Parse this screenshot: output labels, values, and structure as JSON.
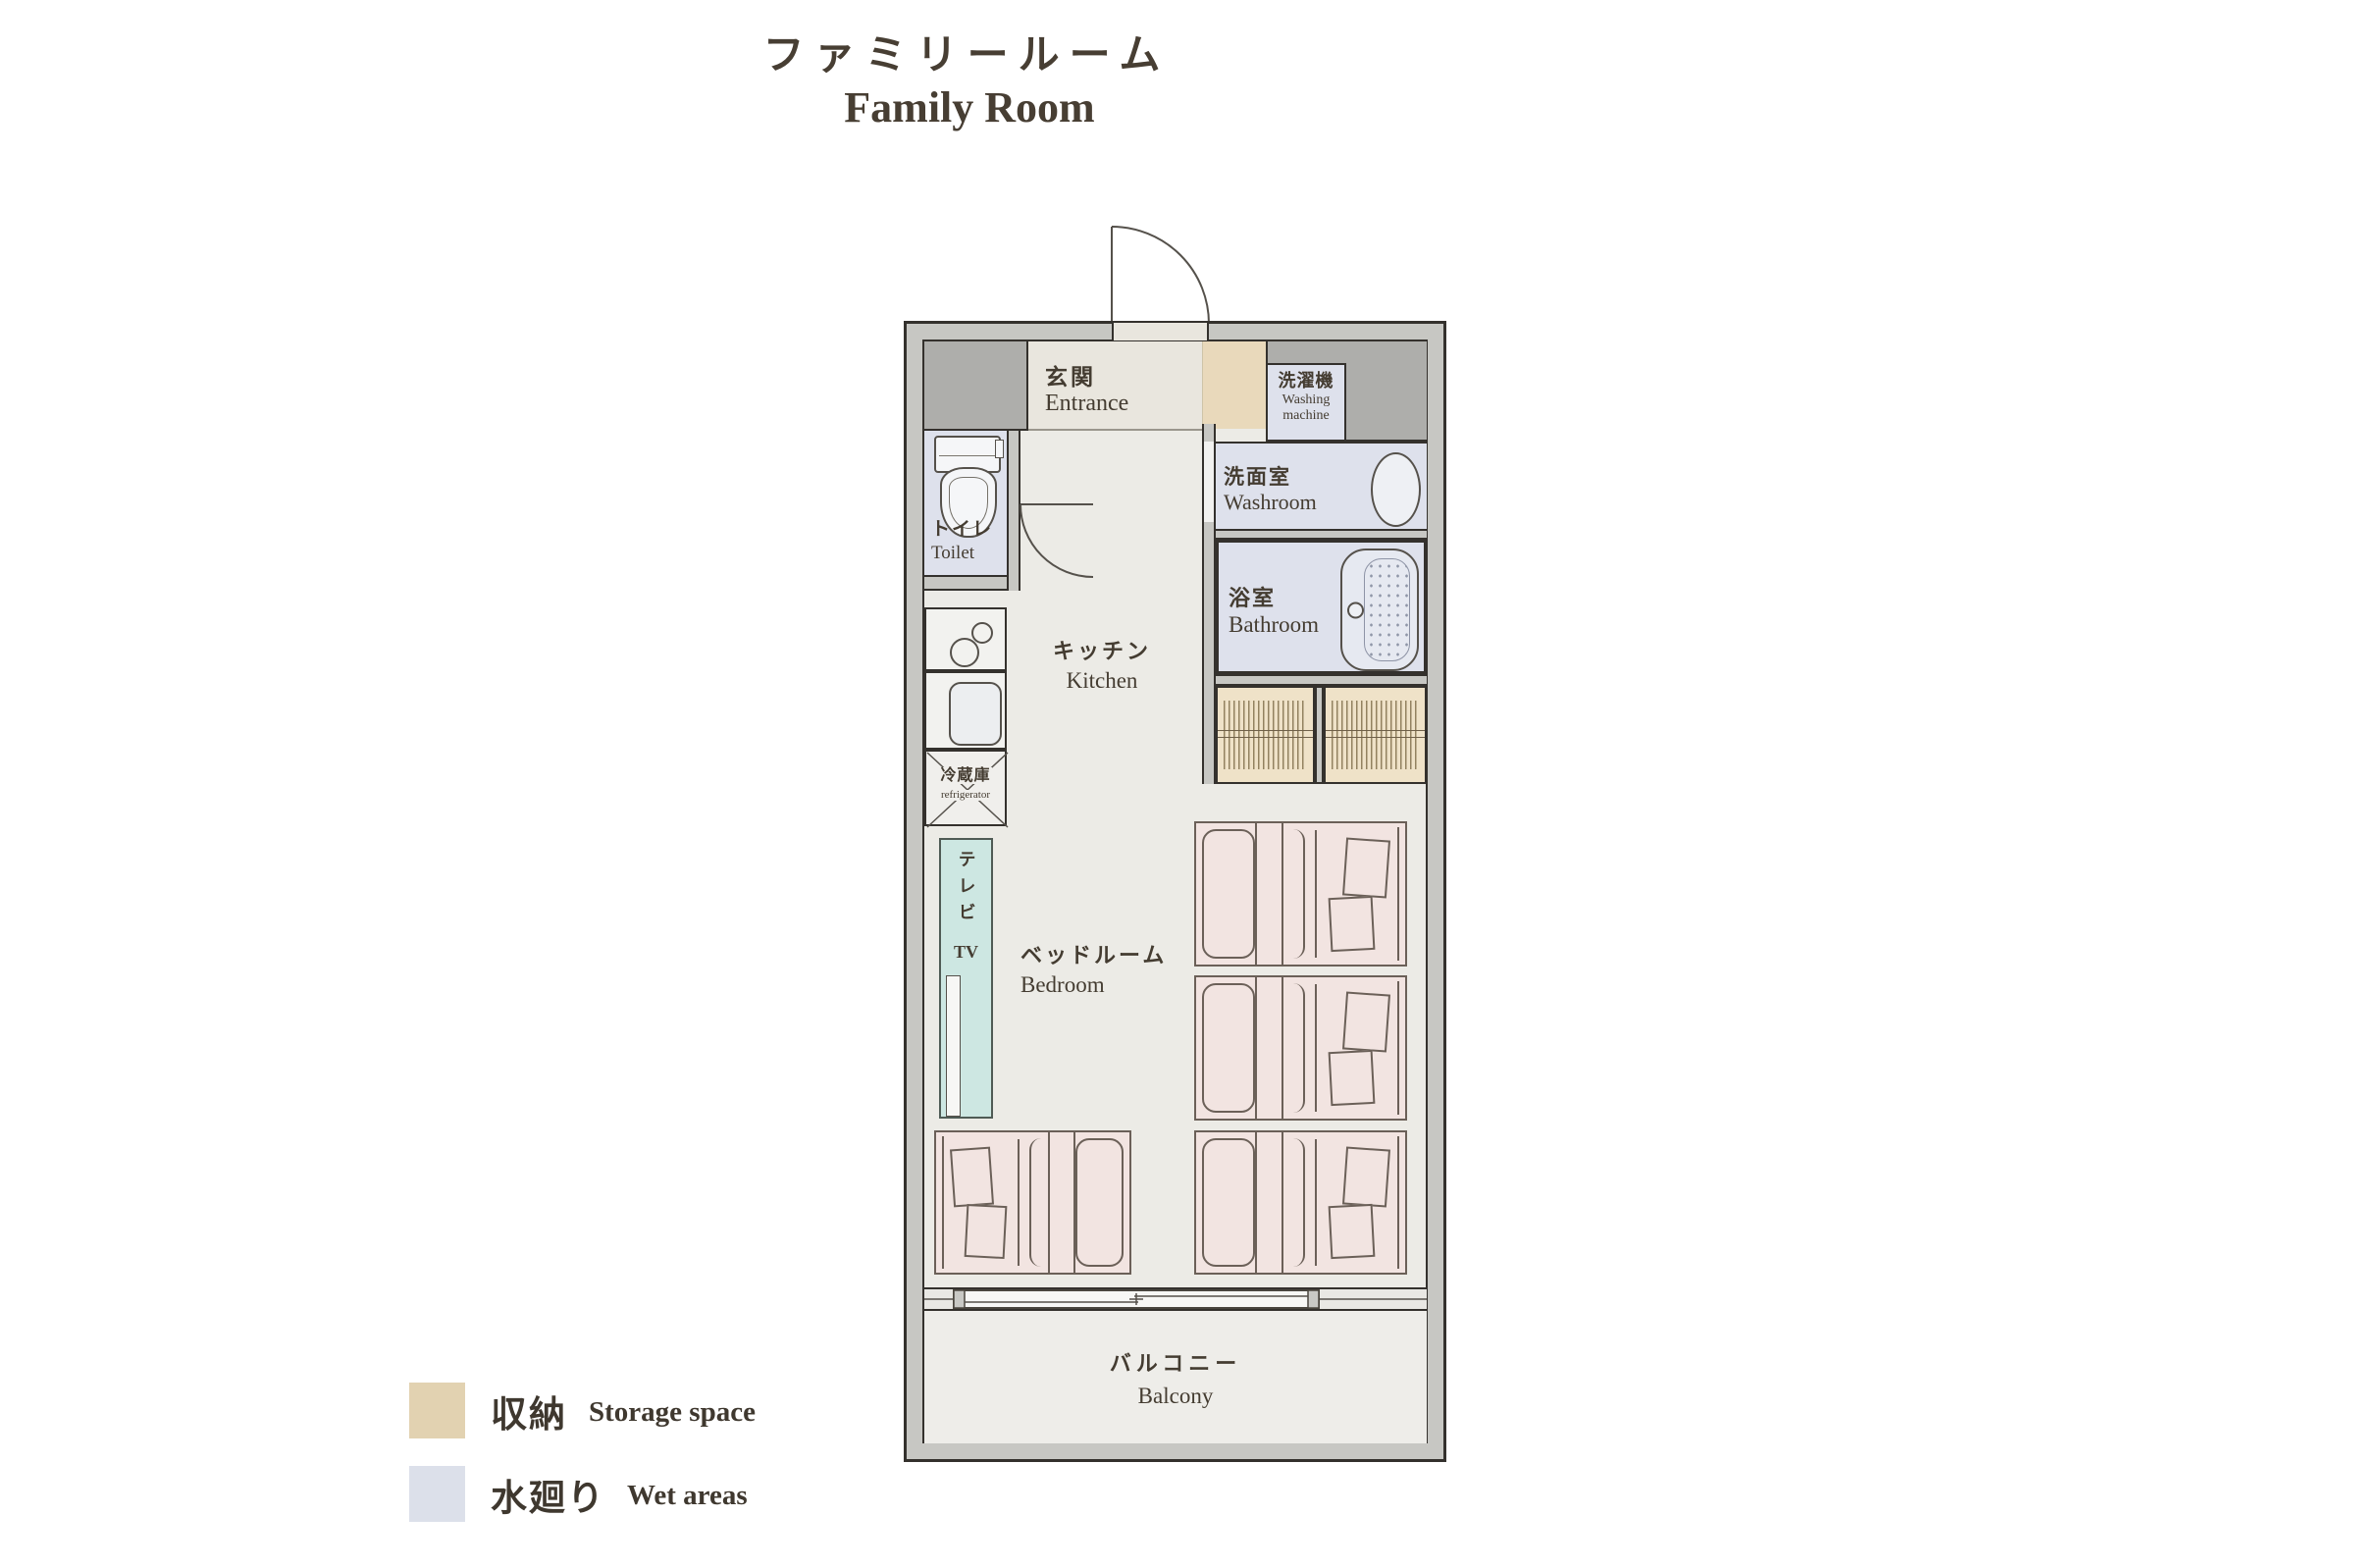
{
  "title": {
    "jp": "ファミリールーム",
    "en": "Family Room"
  },
  "rooms": {
    "entrance": {
      "jp": "玄関",
      "en": "Entrance"
    },
    "washing_machine": {
      "jp": "洗濯機",
      "en_line1": "Washing",
      "en_line2": "machine"
    },
    "toilet": {
      "jp": "トイレ",
      "en": "Toilet"
    },
    "washroom": {
      "jp": "洗面室",
      "en": "Washroom"
    },
    "bathroom": {
      "jp": "浴室",
      "en": "Bathroom"
    },
    "kitchen": {
      "jp": "キッチン",
      "en": "Kitchen"
    },
    "refrigerator": {
      "jp": "冷蔵庫",
      "en": "refrigerator"
    },
    "tv": {
      "jp": "テレビ",
      "en": "TV"
    },
    "bedroom": {
      "jp": "ベッドルーム",
      "en": "Bedroom"
    },
    "balcony": {
      "jp": "バルコニー",
      "en": "Balcony"
    }
  },
  "legend": {
    "storage": {
      "jp": "収納",
      "en": "Storage space",
      "color": "#e2d2b1"
    },
    "wet": {
      "jp": "水廻り",
      "en": "Wet areas",
      "color": "#dce0ea"
    }
  },
  "colors": {
    "wall": "#c7c7c3",
    "floor": "#ecebe6",
    "wet_area": "#dee1ec",
    "storage": "#e9d9bb",
    "bed": "#f2e4e1",
    "tv": "#cde7e2",
    "outline": "#34312d",
    "title_text": "#473e33"
  }
}
